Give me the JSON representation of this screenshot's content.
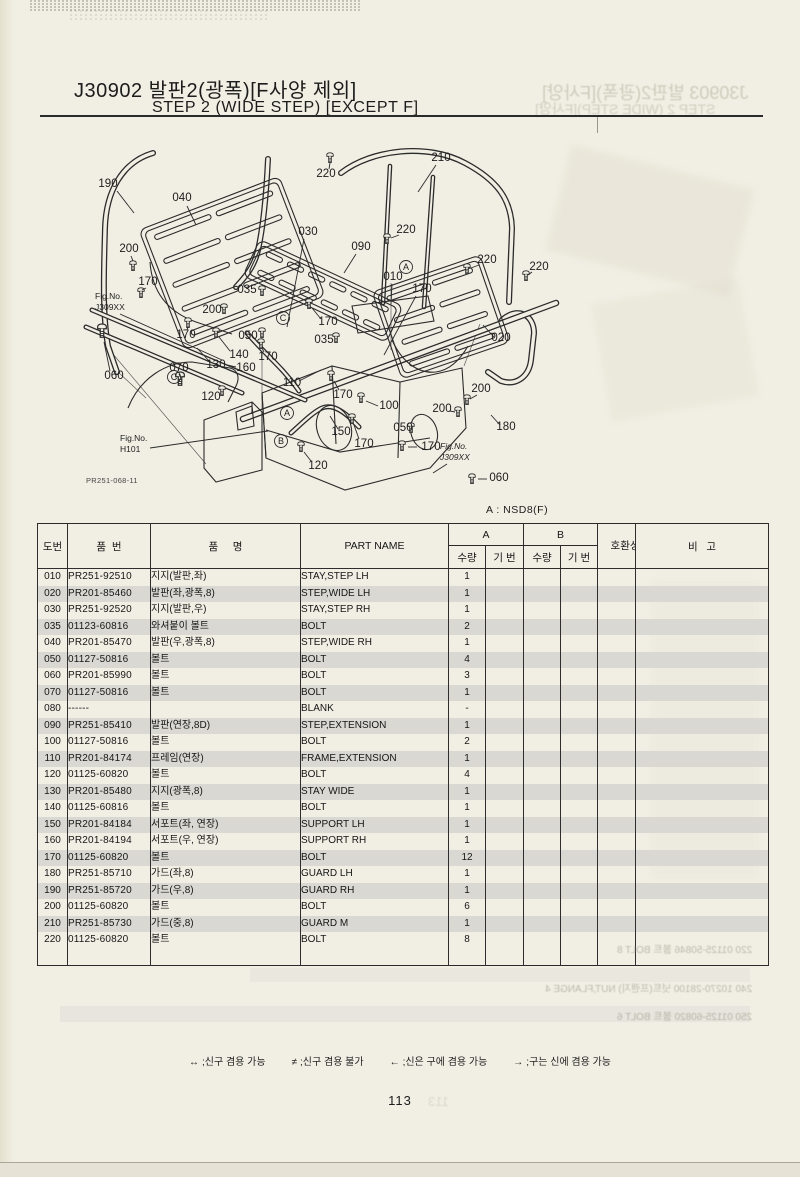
{
  "page": {
    "title_kr": "J30902 발판2(광폭)[F사양 제외]",
    "title_en": "STEP 2 (WIDE STEP) [EXCEPT F]",
    "model_note": "A : NSD8(F)",
    "page_number": "113",
    "footnotes": [
      {
        "symbol": "↔",
        "text": ";신구 겸용 가능"
      },
      {
        "symbol": "≠",
        "text": ";신구 겸용 불가"
      },
      {
        "symbol": "←",
        "text": ";신은 구에 겸용 가능"
      },
      {
        "symbol": "→",
        "text": ";구는 신에 겸용 가능"
      }
    ]
  },
  "table": {
    "headers": {
      "no": "도번",
      "part_no": "품  번",
      "name_kr": "품     명",
      "name_en": "PART NAME",
      "group_a": "A",
      "group_b": "B",
      "qty": "수량",
      "serial": "기 번",
      "compat": "호환성",
      "remark": "비   고"
    },
    "rows": [
      {
        "no": "010",
        "part_no": "PR251-92510",
        "name_kr": "지지(발판,좌)",
        "name_en": "STAY,STEP LH",
        "qty_a": "1",
        "shaded": false
      },
      {
        "no": "020",
        "part_no": "PR201-85460",
        "name_kr": "발판(좌,광폭,8)",
        "name_en": "STEP,WIDE LH",
        "qty_a": "1",
        "shaded": true
      },
      {
        "no": "030",
        "part_no": "PR251-92520",
        "name_kr": "지지(발판,우)",
        "name_en": "STAY,STEP RH",
        "qty_a": "1",
        "shaded": false
      },
      {
        "no": "035",
        "part_no": "01123-60816",
        "name_kr": "와셔붙이 볼트",
        "name_en": "BOLT",
        "qty_a": "2",
        "shaded": true
      },
      {
        "no": "040",
        "part_no": "PR201-85470",
        "name_kr": "발판(우,광폭,8)",
        "name_en": "STEP,WIDE RH",
        "qty_a": "1",
        "shaded": false
      },
      {
        "no": "050",
        "part_no": "01127-50816",
        "name_kr": "볼트",
        "name_en": "BOLT",
        "qty_a": "4",
        "shaded": true
      },
      {
        "no": "060",
        "part_no": "PR201-85990",
        "name_kr": "볼트",
        "name_en": "BOLT",
        "qty_a": "3",
        "shaded": false
      },
      {
        "no": "070",
        "part_no": "01127-50816",
        "name_kr": "볼트",
        "name_en": "BOLT",
        "qty_a": "1",
        "shaded": true
      },
      {
        "no": "080",
        "part_no": "------",
        "name_kr": "",
        "name_en": "BLANK",
        "qty_a": "-",
        "shaded": false
      },
      {
        "no": "090",
        "part_no": "PR251-85410",
        "name_kr": "발판(연장,8D)",
        "name_en": "STEP,EXTENSION",
        "qty_a": "1",
        "shaded": true
      },
      {
        "no": "100",
        "part_no": "01127-50816",
        "name_kr": "볼트",
        "name_en": "BOLT",
        "qty_a": "2",
        "shaded": false
      },
      {
        "no": "110",
        "part_no": "PR201-84174",
        "name_kr": "프레임(연장)",
        "name_en": "FRAME,EXTENSION",
        "qty_a": "1",
        "shaded": true
      },
      {
        "no": "120",
        "part_no": "01125-60820",
        "name_kr": "볼트",
        "name_en": "BOLT",
        "qty_a": "4",
        "shaded": false
      },
      {
        "no": "130",
        "part_no": "PR201-85480",
        "name_kr": "지지(광폭,8)",
        "name_en": "STAY WIDE",
        "qty_a": "1",
        "shaded": true
      },
      {
        "no": "140",
        "part_no": "01125-60816",
        "name_kr": "볼트",
        "name_en": "BOLT",
        "qty_a": "1",
        "shaded": false
      },
      {
        "no": "150",
        "part_no": "PR201-84184",
        "name_kr": "서포트(좌, 연장)",
        "name_en": "SUPPORT LH",
        "qty_a": "1",
        "shaded": true
      },
      {
        "no": "160",
        "part_no": "PR201-84194",
        "name_kr": "서포트(우, 연장)",
        "name_en": "SUPPORT RH",
        "qty_a": "1",
        "shaded": false
      },
      {
        "no": "170",
        "part_no": "01125-60820",
        "name_kr": "볼트",
        "name_en": "BOLT",
        "qty_a": "12",
        "shaded": true
      },
      {
        "no": "180",
        "part_no": "PR251-85710",
        "name_kr": "가드(좌,8)",
        "name_en": "GUARD LH",
        "qty_a": "1",
        "shaded": false
      },
      {
        "no": "190",
        "part_no": "PR251-85720",
        "name_kr": "가드(우,8)",
        "name_en": "GUARD RH",
        "qty_a": "1",
        "shaded": true
      },
      {
        "no": "200",
        "part_no": "01125-60820",
        "name_kr": "볼트",
        "name_en": "BOLT",
        "qty_a": "6",
        "shaded": false
      },
      {
        "no": "210",
        "part_no": "PR251-85730",
        "name_kr": "가드(중,8)",
        "name_en": "GUARD M",
        "qty_a": "1",
        "shaded": true
      },
      {
        "no": "220",
        "part_no": "01125-60820",
        "name_kr": "볼트",
        "name_en": "BOLT",
        "qty_a": "8",
        "shaded": false
      }
    ]
  },
  "diagram": {
    "drawing_no": {
      "text": "PR251-068-11",
      "x": 86,
      "y": 483
    },
    "labels": [
      {
        "t": "190",
        "x": 108,
        "y": 187,
        "l": [
          117,
          191,
          134,
          213
        ]
      },
      {
        "t": "040",
        "x": 182,
        "y": 201,
        "l": [
          187,
          206,
          196,
          225
        ]
      },
      {
        "t": "200",
        "x": 129,
        "y": 252,
        "l": [
          131,
          256,
          133,
          261
        ]
      },
      {
        "t": "170",
        "x": 148,
        "y": 285,
        "l": [
          146,
          288,
          142,
          290
        ]
      },
      {
        "t": "030",
        "x": 308,
        "y": 235,
        "l": [
          304,
          239,
          287,
          327
        ]
      },
      {
        "t": "090",
        "x": 361,
        "y": 250,
        "l": [
          356,
          254,
          344,
          273
        ]
      },
      {
        "t": "220",
        "x": 326,
        "y": 177,
        "l": [
          329,
          169,
          330,
          163
        ]
      },
      {
        "t": "210",
        "x": 441,
        "y": 161,
        "l": [
          436,
          165,
          418,
          192
        ]
      },
      {
        "t": "220",
        "x": 406,
        "y": 233,
        "l": [
          399,
          235,
          391,
          238
        ]
      },
      {
        "t": "220",
        "x": 487,
        "y": 263,
        "l": [
          479,
          265,
          471,
          268
        ]
      },
      {
        "t": "220",
        "x": 539,
        "y": 270,
        "l": [
          532,
          272,
          528,
          275
        ]
      },
      {
        "t": "010",
        "x": 393,
        "y": 280,
        "l": [
          392,
          284,
          391,
          304
        ]
      },
      {
        "t": "170",
        "x": 422,
        "y": 292,
        "l": [
          416,
          296,
          384,
          355
        ]
      },
      {
        "t": "035",
        "x": 247,
        "y": 293
      },
      {
        "t": "200",
        "x": 212,
        "y": 313
      },
      {
        "t": "170",
        "x": 186,
        "y": 338,
        "l": [
          187,
          330,
          188,
          327
        ]
      },
      {
        "t": "050",
        "x": 248,
        "y": 339
      },
      {
        "t": "140",
        "x": 239,
        "y": 358,
        "l": [
          230,
          351,
          219,
          337
        ]
      },
      {
        "t": "170",
        "x": 268,
        "y": 360,
        "l": [
          264,
          352,
          262,
          348
        ]
      },
      {
        "t": "070",
        "x": 179,
        "y": 371,
        "l": [
          179,
          374,
          180,
          376
        ]
      },
      {
        "t": "130",
        "x": 216,
        "y": 368,
        "l": [
          210,
          362,
          197,
          348
        ]
      },
      {
        "t": "160",
        "x": 246,
        "y": 371,
        "l": [
          236,
          367,
          227,
          365
        ]
      },
      {
        "t": "110",
        "x": 292,
        "y": 386,
        "l": [
          299,
          381,
          321,
          370
        ]
      },
      {
        "t": "060",
        "x": 114,
        "y": 379,
        "l": [
          110,
          371,
          104,
          342
        ]
      },
      {
        "t": "120",
        "x": 211,
        "y": 400
      },
      {
        "t": "170",
        "x": 328,
        "y": 325,
        "l": [
          321,
          319,
          312,
          308
        ]
      },
      {
        "t": "035",
        "x": 324,
        "y": 343
      },
      {
        "t": "170",
        "x": 343,
        "y": 398,
        "l": [
          339,
          390,
          334,
          381
        ]
      },
      {
        "t": "100",
        "x": 389,
        "y": 409,
        "l": [
          378,
          406,
          366,
          401
        ]
      },
      {
        "t": "050",
        "x": 403,
        "y": 431
      },
      {
        "t": "150",
        "x": 341,
        "y": 435,
        "l": [
          338,
          429,
          330,
          416
        ]
      },
      {
        "t": "170",
        "x": 364,
        "y": 447,
        "l": [
          359,
          439,
          354,
          425
        ]
      },
      {
        "t": "170",
        "x": 431,
        "y": 450,
        "l": [
          417,
          447,
          408,
          447
        ]
      },
      {
        "t": "120",
        "x": 318,
        "y": 469,
        "l": [
          311,
          461,
          304,
          452
        ]
      },
      {
        "t": "200",
        "x": 481,
        "y": 392,
        "l": [
          477,
          395,
          470,
          399
        ]
      },
      {
        "t": "200",
        "x": 442,
        "y": 412,
        "l": [
          450,
          411,
          455,
          412
        ]
      },
      {
        "t": "180",
        "x": 506,
        "y": 430,
        "l": [
          500,
          425,
          491,
          415
        ]
      },
      {
        "t": "020",
        "x": 501,
        "y": 341,
        "l": [
          494,
          337,
          483,
          325
        ]
      },
      {
        "t": "060",
        "x": 499,
        "y": 481,
        "l": [
          487,
          479,
          478,
          479
        ]
      }
    ],
    "connectors": [
      {
        "letter": "A",
        "x": 406,
        "y": 267
      },
      {
        "letter": "C",
        "x": 283,
        "y": 318
      },
      {
        "letter": "C",
        "x": 174,
        "y": 377
      },
      {
        "letter": "A",
        "x": 287,
        "y": 413
      },
      {
        "letter": "B",
        "x": 281,
        "y": 441
      }
    ],
    "fig_refs": [
      {
        "line1": "Fig.No.",
        "line2": "J309XX",
        "x": 95,
        "y": 299,
        "italic": false,
        "l": [
          120,
          314,
          222,
          360
        ]
      },
      {
        "line1": "Fig.No.",
        "line2": "H101",
        "x": 120,
        "y": 441,
        "italic": false,
        "l": [
          150,
          448,
          268,
          431
        ]
      },
      {
        "line1": "Fig.No.",
        "line2": "J309XX",
        "x": 440,
        "y": 449,
        "italic": true,
        "l": [
          447,
          464,
          433,
          473
        ]
      }
    ],
    "bolts": [
      [
        330,
        158
      ],
      [
        387,
        239
      ],
      [
        467,
        269
      ],
      [
        526,
        276
      ],
      [
        133,
        266
      ],
      [
        224,
        309
      ],
      [
        467,
        400
      ],
      [
        458,
        412
      ],
      [
        141,
        293
      ],
      [
        188,
        323
      ],
      [
        261,
        344
      ],
      [
        309,
        304
      ],
      [
        331,
        376
      ],
      [
        352,
        419
      ],
      [
        402,
        446
      ],
      [
        262,
        291
      ],
      [
        336,
        338
      ],
      [
        262,
        333
      ],
      [
        411,
        428
      ],
      [
        216,
        333
      ],
      [
        180,
        379,
        1.35
      ],
      [
        102,
        331,
        1.35
      ],
      [
        472,
        479
      ],
      [
        361,
        398
      ],
      [
        222,
        391
      ],
      [
        301,
        447
      ]
    ],
    "panels": [
      {
        "cx": 232,
        "cy": 263,
        "w": 150,
        "h": 128,
        "rot": -21,
        "rows": 5,
        "cols": 2
      },
      {
        "cx": 323,
        "cy": 291,
        "w": 158,
        "h": 40,
        "rot": 25,
        "rows": 2,
        "cols": 6
      },
      {
        "cx": 441,
        "cy": 317,
        "w": 114,
        "h": 92,
        "rot": -19,
        "rows": 4,
        "cols": 2
      }
    ]
  },
  "ghosts": {
    "title1": "J30903 발판2(광폭)[F사양]",
    "title2": "STEP 2 (WIDE STEP)[F사양]",
    "rows": [
      {
        "text": "220 01125-50846  볼트  BOLT  8",
        "y": 941
      },
      {
        "text": "240 10270-28100  넛트(프랜지)  NUT,FLANGE  4",
        "y": 980
      },
      {
        "text": "250 01125-60820  볼트  BOLT  6",
        "y": 1008
      }
    ],
    "page_number": "113"
  }
}
